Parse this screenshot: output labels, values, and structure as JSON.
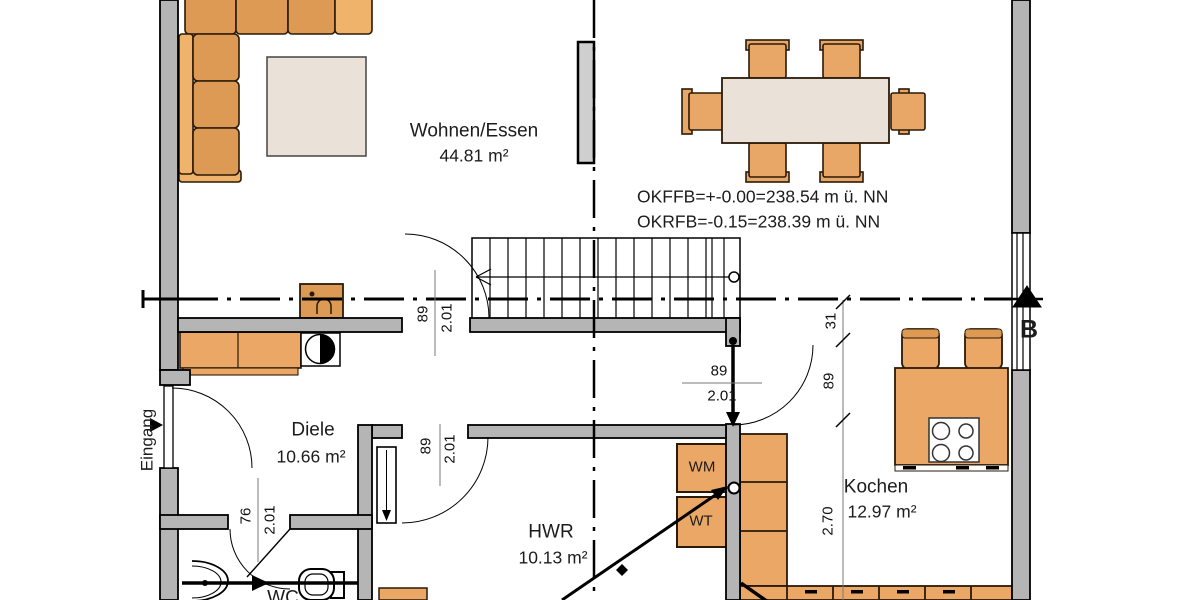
{
  "plan": {
    "rooms": [
      {
        "id": "wohnen",
        "name": "Wohnen/Essen",
        "area": "44.81 m²"
      },
      {
        "id": "diele",
        "name": "Diele",
        "area": "10.66 m²"
      },
      {
        "id": "hwr",
        "name": "HWR",
        "area": "10.13 m²"
      },
      {
        "id": "kochen",
        "name": "Kochen",
        "area": "12.97 m²"
      },
      {
        "id": "wc",
        "name": "WC",
        "area": ""
      }
    ],
    "levels": {
      "line1": "OKFFB=+-0.00=238.54 m ü. NN",
      "line2": "OKRFB=-0.15=238.39 m ü. NN"
    },
    "entrance_label": "Eingang",
    "section_label": "B",
    "appliances": {
      "washer": "WM",
      "dryer": "WT"
    },
    "dims": {
      "stair_door_w": "89",
      "stair_door_h": "2.01",
      "hwr_door_w": "89",
      "hwr_door_h": "2.01",
      "kitchen_door_w": "89",
      "kitchen_door_h": "2.01",
      "wc_door_w": "76",
      "wc_door_h": "2.01",
      "kitchen_seg_a": "31",
      "kitchen_seg_b": "89",
      "kitchen_depth": "2.70"
    },
    "colors": {
      "furniture": "#eba765",
      "furniture_dark": "#dd9a55",
      "furniture_light": "#f0b36b",
      "surface": "#eae2d8",
      "wall": "#b5b5b5"
    }
  }
}
